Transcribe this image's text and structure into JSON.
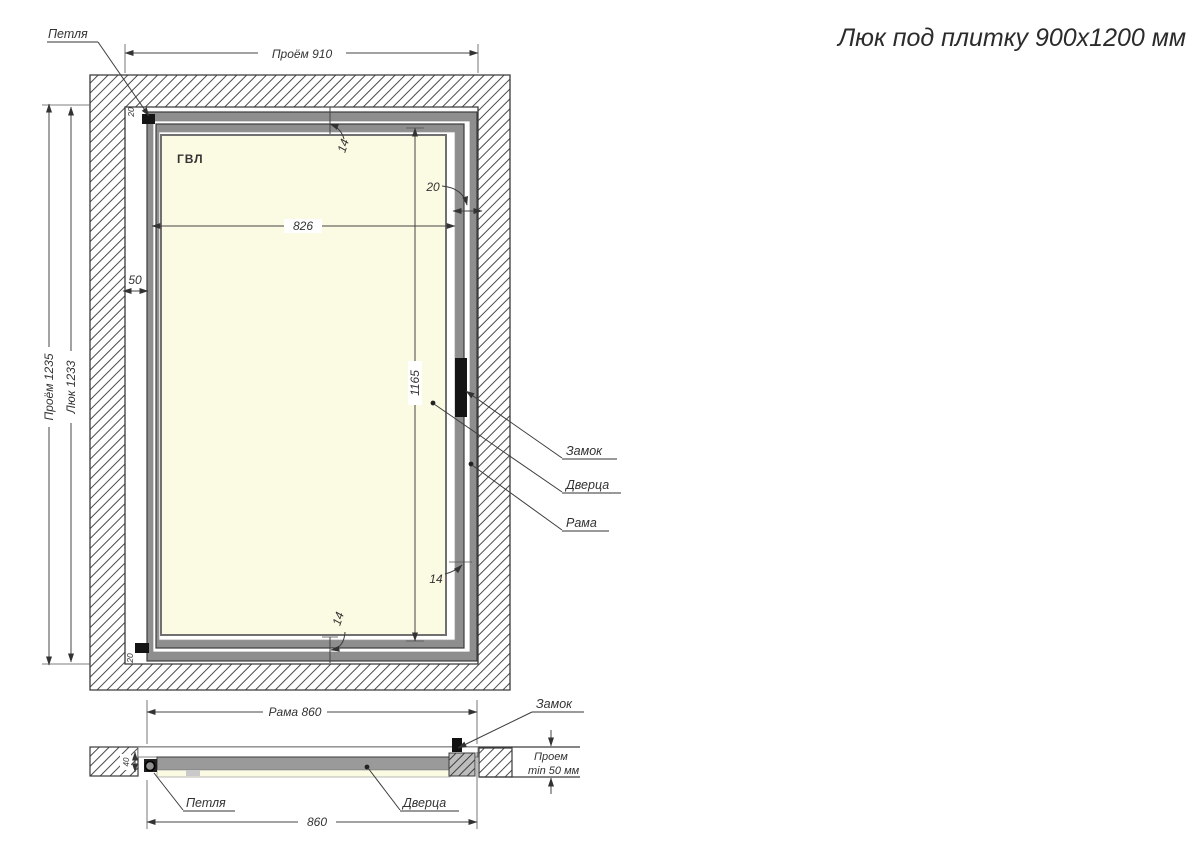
{
  "title": "Люк под плитку 900х1200 мм",
  "colors": {
    "panel_fill": "#fbfae3",
    "metal_gray": "#8e8e8e",
    "line": "#3c3c3c",
    "hatch": "#4a4a4a"
  },
  "main_view": {
    "material": "ГВЛ",
    "hinge_label": "Петля",
    "lock_label": "Замок",
    "door_label": "Дверца",
    "frame_label": "Рама",
    "dim_opening_width": "Проём 910",
    "dim_opening_height": "Проём 1235",
    "dim_hatch_height": "Люк 1233",
    "dim_side_gap": "50",
    "dim_panel_width": "826",
    "dim_panel_height": "1165",
    "dim_margin_top": "14",
    "dim_margin_bottom": "14",
    "dim_margin_right": "14",
    "dim_frame_depth": "20",
    "dim_hinge_offset_top": "20",
    "dim_hinge_offset_bottom": "20"
  },
  "section_view": {
    "hinge_label": "Петля",
    "lock_label": "Замок",
    "door_label": "Дверца",
    "dim_frame_width": "Рама 860",
    "dim_door_width": "860",
    "dim_wall_thickness": "40",
    "depth_note_line1": "Проем",
    "depth_note_line2": "min 50 мм"
  }
}
